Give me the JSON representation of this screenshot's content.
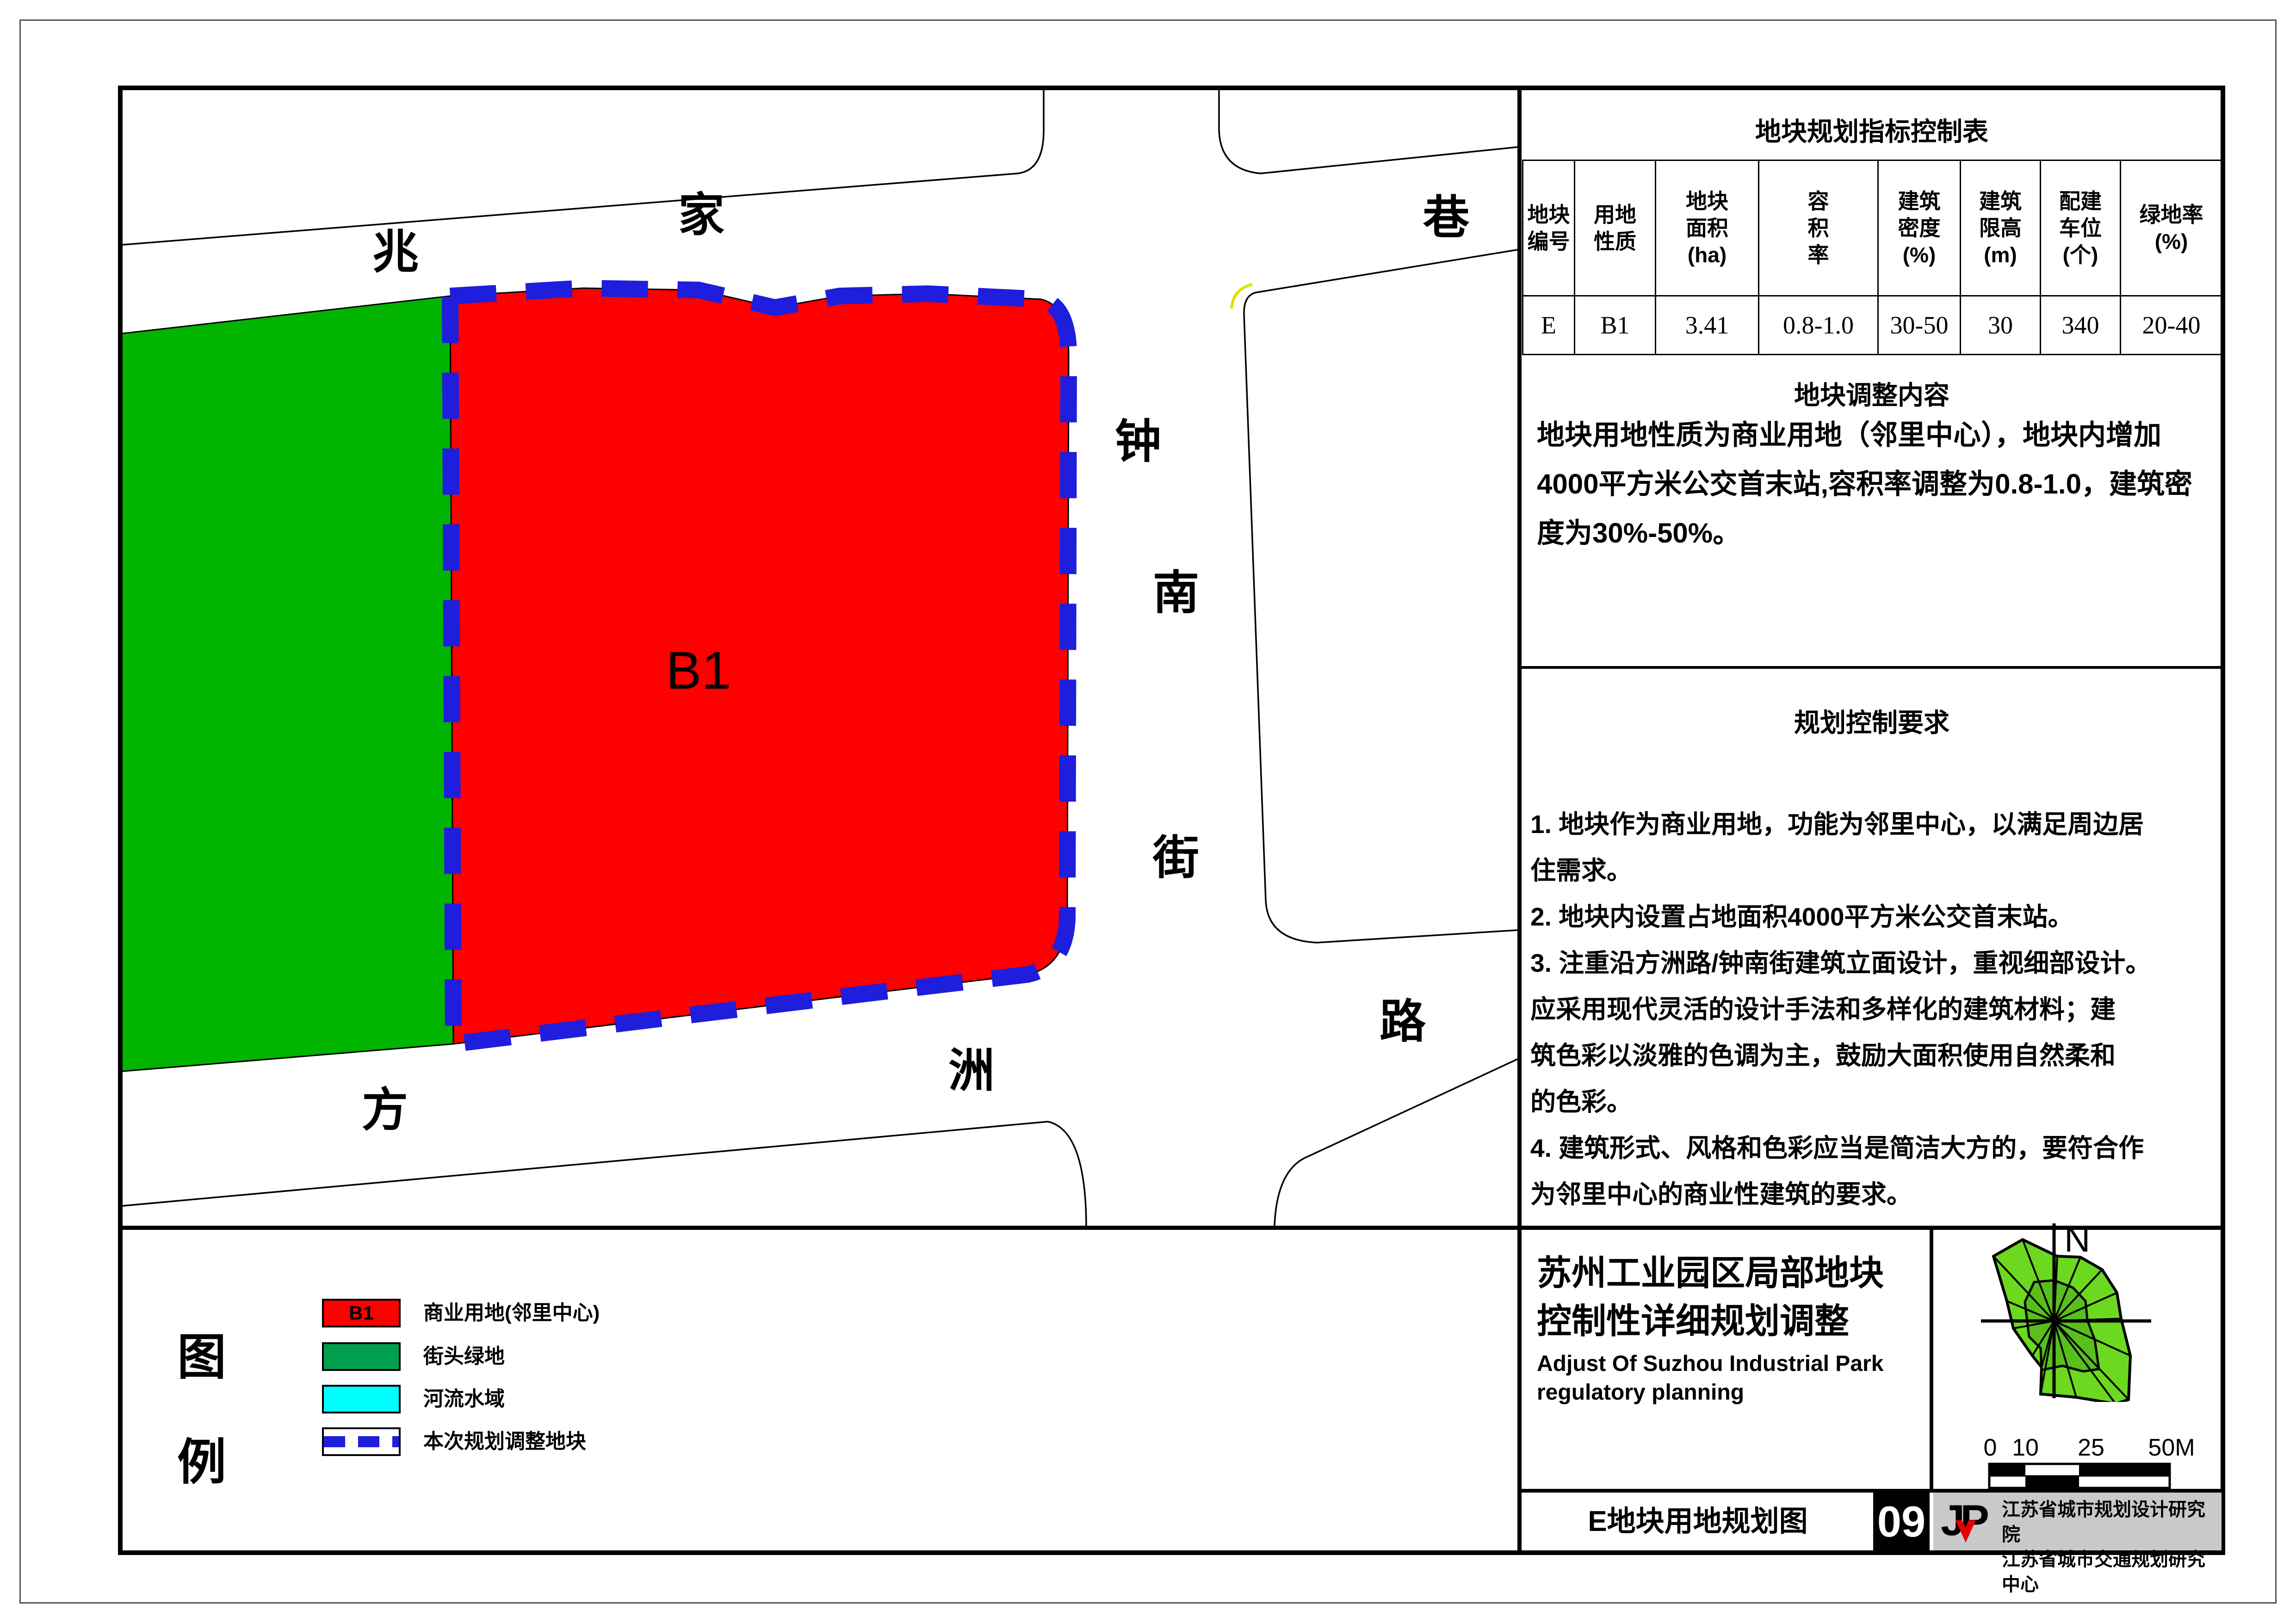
{
  "map": {
    "parcel_label": "B1",
    "roads": {
      "zhaojia_xiang": [
        "兆",
        "家",
        "巷"
      ],
      "zhongnan_jie": [
        "钟",
        "南",
        "街"
      ],
      "fangzhou_lu": [
        "方",
        "洲",
        "路"
      ]
    },
    "colors": {
      "commercial_red": "#fe0000",
      "map_green": "#00b400",
      "dash_blue": "#1e1edc",
      "road_line": "#000000"
    }
  },
  "indicator_table": {
    "title": "地块规划指标控制表",
    "headers": [
      "地块\n编号",
      "用地\n性质",
      "地块\n面积\n(ha)",
      "容\n积\n率",
      "建筑\n密度\n(%)",
      "建筑\n限高\n(m)",
      "配建\n车位\n(个)",
      "绿地率\n(%)"
    ],
    "row": [
      "E",
      "B1",
      "3.41",
      "0.8-1.0",
      "30-50",
      "30",
      "340",
      "20-40"
    ]
  },
  "adjustment": {
    "title": "地块调整内容",
    "body": "地块用地性质为商业用地（邻里中心），地块内增加\n4000平方米公交首末站,容积率调整为0.8-1.0，建筑密\n度为30%-50%。"
  },
  "requirements": {
    "title": "规划控制要求",
    "body": "1. 地块作为商业用地，功能为邻里中心，以满足周边居\n 住需求。\n2. 地块内设置占地面积4000平方米公交首末站。\n3. 注重沿方洲路/钟南街建筑立面设计，重视细部设计。\n 应采用现代灵活的设计手法和多样化的建筑材料；建\n 筑色彩以淡雅的色调为主，鼓励大面积使用自然柔和\n 的色彩。\n4. 建筑形式、风格和色彩应当是简洁大方的，要符合作\n 为邻里中心的商业性建筑的要求。"
  },
  "title_block": {
    "title_cn": "苏州工业园区局部地块\n控制性详细规划调整",
    "title_en": "Adjust Of Suzhou Industrial Park\n regulatory planning",
    "north_label": "N",
    "scale_ticks": [
      "0",
      "10",
      "25",
      "50M"
    ]
  },
  "footer": {
    "drawing_title": "E地块用地规划图",
    "sheet_number": "09",
    "logo_text": "JP",
    "institutions": "江苏省城市规划设计研究院\n江苏省城市交通规划研究中心"
  },
  "legend": {
    "heading": [
      "图",
      "例"
    ],
    "items": [
      {
        "code": "B1",
        "label": "商业用地(邻里中心)",
        "color": "#fe0000"
      },
      {
        "code": "",
        "label": "街头绿地",
        "color": "#00a04e"
      },
      {
        "code": "",
        "label": "河流水域",
        "color": "#00ffff"
      },
      {
        "code": "",
        "label": "本次规划调整地块",
        "color": "dashed-blue"
      }
    ]
  }
}
